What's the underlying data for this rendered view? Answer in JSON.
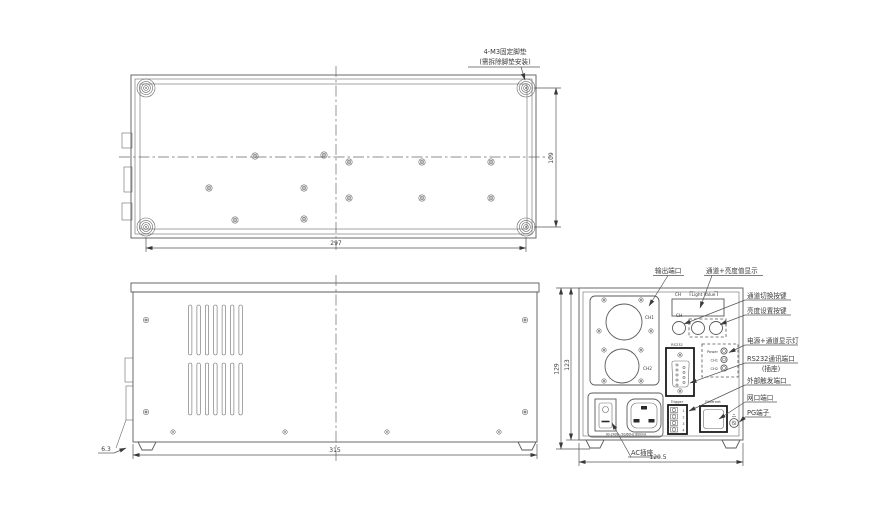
{
  "top_view": {
    "note_line1": "4-M3固定脚垫",
    "note_line2": "(需拆除脚垫安装)",
    "dim_width": "297",
    "dim_height": "109"
  },
  "side_view": {
    "dim_length": "315",
    "dim_foot": "6.3"
  },
  "rear_view": {
    "callout_output": "输出端口",
    "callout_display": "通道+亮度值显示",
    "callout_ch_switch": "通道切换按键",
    "callout_brightness": "亮度设置按键",
    "callout_leds": "电源+通道显示灯",
    "callout_rs232_line1": "RS232通讯端口",
    "callout_rs232_line2": "(插座)",
    "callout_trigger": "外部触发端口",
    "callout_ethernet": "网口端口",
    "callout_pg": "PG端子",
    "callout_ac": "AC插座",
    "dim_width": "120.5",
    "dim_height_outer": "129",
    "dim_height_inner": "123",
    "panel": {
      "ch1": "CH1",
      "ch2": "CH2",
      "display_ch": "CH",
      "display_value": "Light Value",
      "button_ch": "CH",
      "rs232": "RS232",
      "led_power": "Power",
      "led_ch1": "CH1",
      "led_ch2": "CH2",
      "trigger": "Trigger",
      "ethernet": "Ethernet",
      "trigger_pins": [
        "1",
        "2",
        "3",
        "4"
      ],
      "ac_rating": "90-240V~50/60Hz 800mA"
    }
  }
}
